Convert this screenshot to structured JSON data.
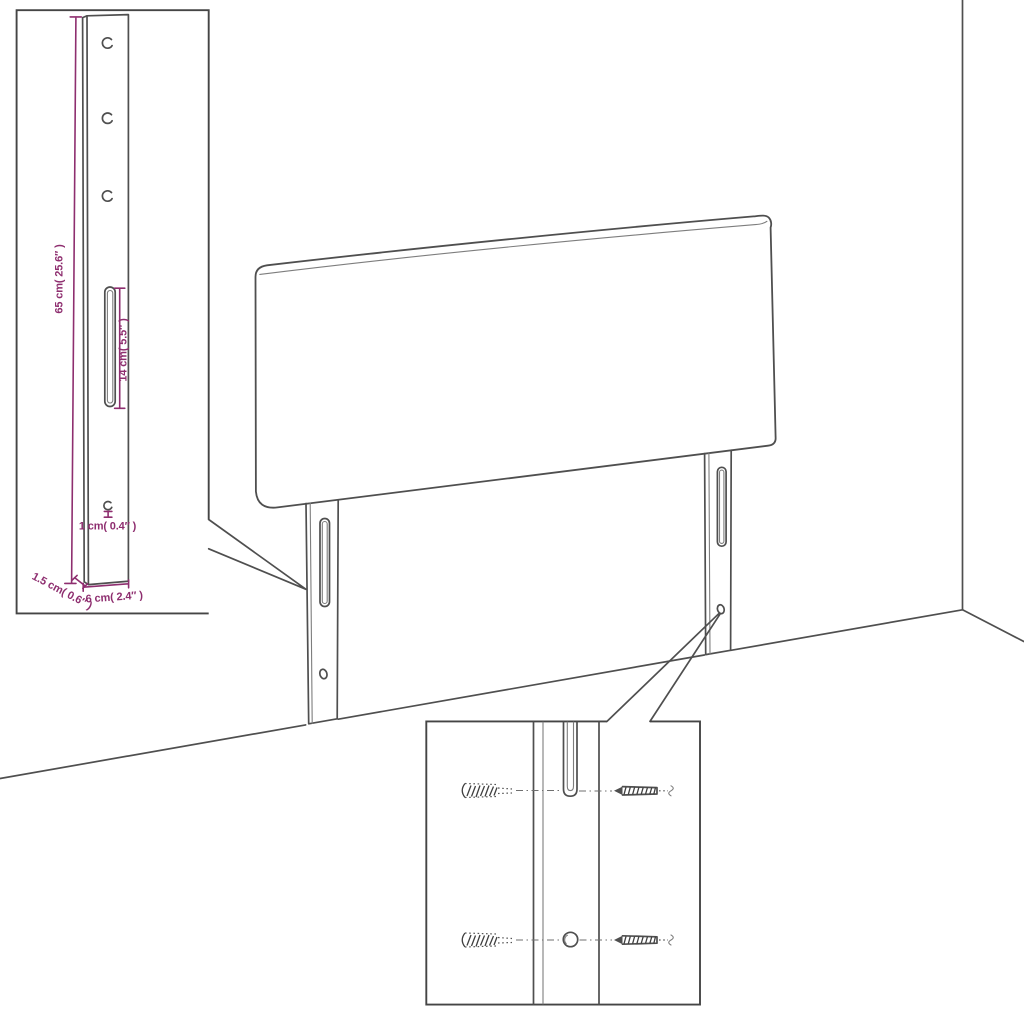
{
  "diagram": {
    "background_color": "#ffffff",
    "line_color": "#4f4f4f",
    "dimension_color": "#8e2e6f",
    "labels": {
      "leg_height": "65 cm( 25.6″ )",
      "slot_length": "14 cm( 5.5″ )",
      "hole_diameter": "1 cm( 0.4″ )",
      "leg_thickness": "1.5 cm( 0.6″ )",
      "leg_width": "6 cm( 2.4″ )"
    },
    "parts": {
      "main": "headboard-with-legs",
      "inset_top_left": "leg-dimension-detail",
      "inset_bottom": "mounting-hardware-detail",
      "hardware": [
        "wall-plug",
        "screw"
      ]
    }
  }
}
